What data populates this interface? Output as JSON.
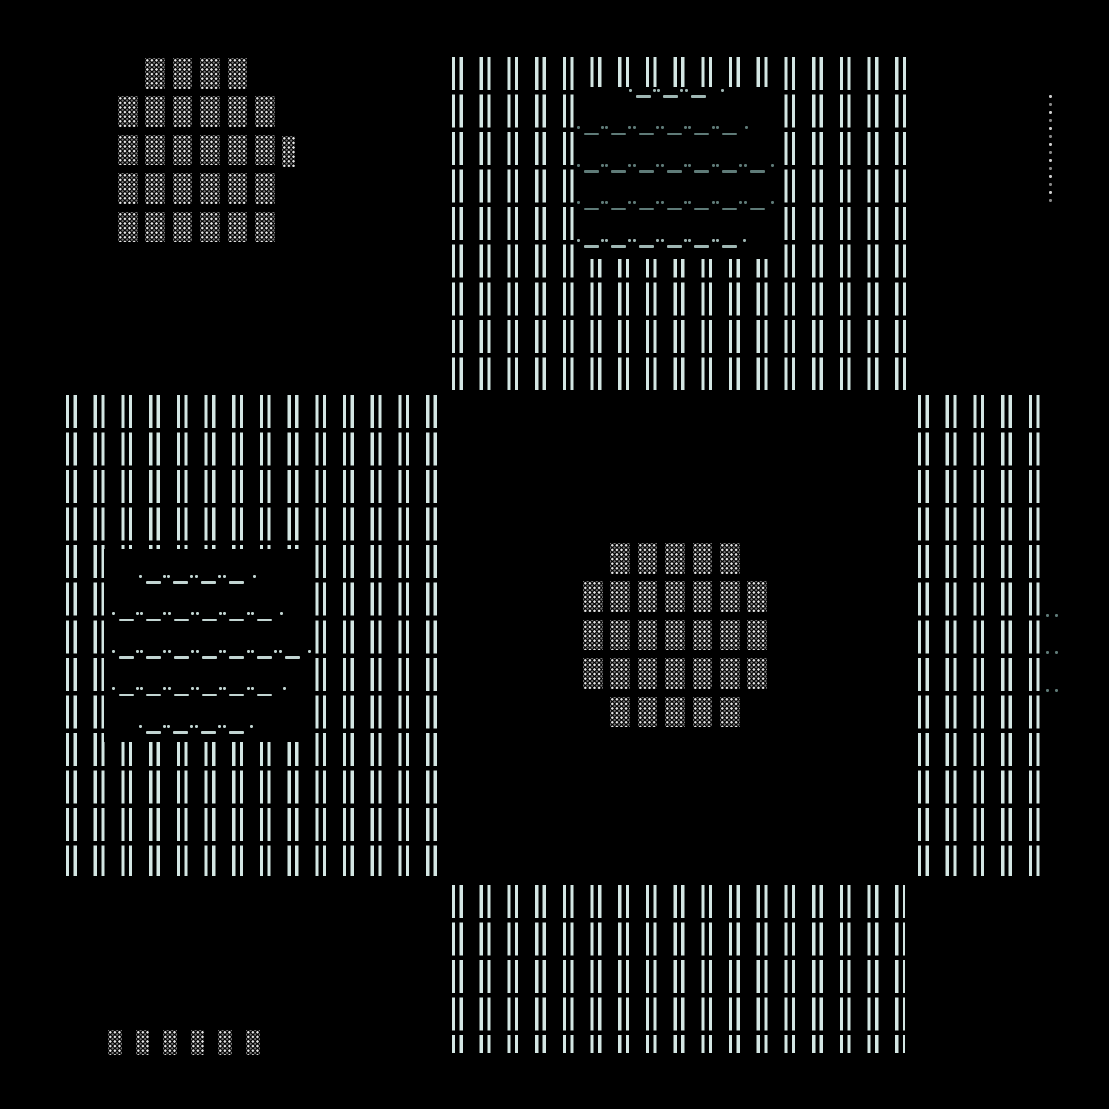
{
  "canvas": {
    "width": 1109,
    "height": 1109,
    "background": "#000000"
  },
  "palette": {
    "bars": "#d4e7e4",
    "contour_dark": "#5f7b78",
    "contour_mid": "#9fb6b3",
    "contour_pale": "#c2d5d2",
    "shade_bright": "#e9e9e9",
    "shade_dim": "#787878",
    "dotline_bright": "#cfcfcf",
    "dotline_dim": "#8a8a8a"
  },
  "glyphs": {
    "col_pitch": 27.7,
    "row_pitch": 37.55,
    "bar_segment_h": 33,
    "bar_stroke_w": 3.2,
    "bar_inner_gap": 4.4,
    "dash_w": 15,
    "dash_h": 2.6,
    "dot_size": 3,
    "shade_dot_pitch": 4.6
  },
  "bar_fields": [
    {
      "name": "top-middle",
      "x": 452,
      "y": 57,
      "w": 456,
      "h": 333
    },
    {
      "name": "left-middle",
      "x": 66,
      "y": 395,
      "w": 371,
      "h": 481
    },
    {
      "name": "right-middle",
      "x": 918,
      "y": 395,
      "w": 124,
      "h": 481
    },
    {
      "name": "bottom-middle",
      "x": 452,
      "y": 885,
      "w": 453,
      "h": 168
    }
  ],
  "voids": [
    {
      "name": "top-middle-void",
      "x": 576,
      "y": 87,
      "w": 198,
      "h": 172
    },
    {
      "name": "left-middle-void",
      "x": 104,
      "y": 549,
      "w": 211,
      "h": 193
    }
  ],
  "contour_lines": [
    {
      "x0": 630,
      "x1": 718,
      "y": 95,
      "color": "contour_mid"
    },
    {
      "x0": 578,
      "x1": 742,
      "y": 132.5,
      "color": "contour_dark"
    },
    {
      "x0": 578,
      "x1": 768,
      "y": 170,
      "color": "contour_dark"
    },
    {
      "x0": 578,
      "x1": 768,
      "y": 207.5,
      "color": "contour_dark"
    },
    {
      "x0": 578,
      "x1": 740,
      "y": 245,
      "color": "contour_mid"
    },
    {
      "x0": 140,
      "x1": 250,
      "y": 581,
      "color": "contour_pale"
    },
    {
      "x0": 113,
      "x1": 277,
      "y": 618.5,
      "color": "contour_pale"
    },
    {
      "x0": 113,
      "x1": 305,
      "y": 656,
      "color": "contour_pale"
    },
    {
      "x0": 113,
      "x1": 280,
      "y": 693.5,
      "color": "contour_pale"
    },
    {
      "x0": 140,
      "x1": 247,
      "y": 731,
      "color": "contour_pale"
    },
    {
      "x0": 1047,
      "x1": 1052,
      "y": 620,
      "color": "contour_dark"
    },
    {
      "x0": 1047,
      "x1": 1052,
      "y": 657.5,
      "color": "contour_dark"
    },
    {
      "x0": 1047,
      "x1": 1052,
      "y": 695,
      "color": "contour_dark"
    }
  ],
  "shade_blobs": [
    {
      "name": "top-left-blob",
      "block_w": 19.5,
      "block_h": 30.5,
      "rows": [
        {
          "y": 58,
          "xs": [
            145.4,
            172.8,
            200.2,
            227.6
          ]
        },
        {
          "y": 96.4,
          "xs": [
            118,
            145.4,
            172.8,
            200.2,
            227.6,
            255
          ]
        },
        {
          "y": 134.8,
          "xs": [
            118,
            145.4,
            172.8,
            200.2,
            227.6,
            255
          ]
        },
        {
          "y": 173.2,
          "xs": [
            118,
            145.4,
            172.8,
            200.2,
            227.6,
            255
          ]
        },
        {
          "y": 211.6,
          "xs": [
            118,
            145.4,
            172.8,
            200.2,
            227.6,
            255
          ]
        }
      ],
      "extra_blocks": [
        {
          "x": 281.5,
          "y": 136,
          "w": 13.5,
          "h": 31
        }
      ]
    },
    {
      "name": "center-blob",
      "block_w": 19.5,
      "block_h": 30.5,
      "rows": [
        {
          "y": 543,
          "xs": [
            610.4,
            637.8,
            665.2,
            692.6,
            720
          ]
        },
        {
          "y": 581.4,
          "xs": [
            583,
            610.4,
            637.8,
            665.2,
            692.6,
            720,
            747.4
          ]
        },
        {
          "y": 619.8,
          "xs": [
            583,
            610.4,
            637.8,
            665.2,
            692.6,
            720,
            747.4
          ]
        },
        {
          "y": 658.2,
          "xs": [
            583,
            610.4,
            637.8,
            665.2,
            692.6,
            720,
            747.4
          ]
        },
        {
          "y": 696.6,
          "xs": [
            610.4,
            637.8,
            665.2,
            692.6,
            720
          ]
        }
      ],
      "extra_blocks": []
    },
    {
      "name": "bottom-left-row",
      "block_w": 13.5,
      "block_h": 25,
      "rows": [
        {
          "y": 1030,
          "xs": [
            108,
            135.6,
            163.2,
            190.8,
            218.4,
            246
          ]
        }
      ],
      "extra_blocks": []
    }
  ],
  "dotted_line": {
    "name": "right-edge-dotted-line",
    "x": 1049,
    "y0": 95,
    "pitch": 8,
    "count": 14,
    "size": 2.5
  }
}
